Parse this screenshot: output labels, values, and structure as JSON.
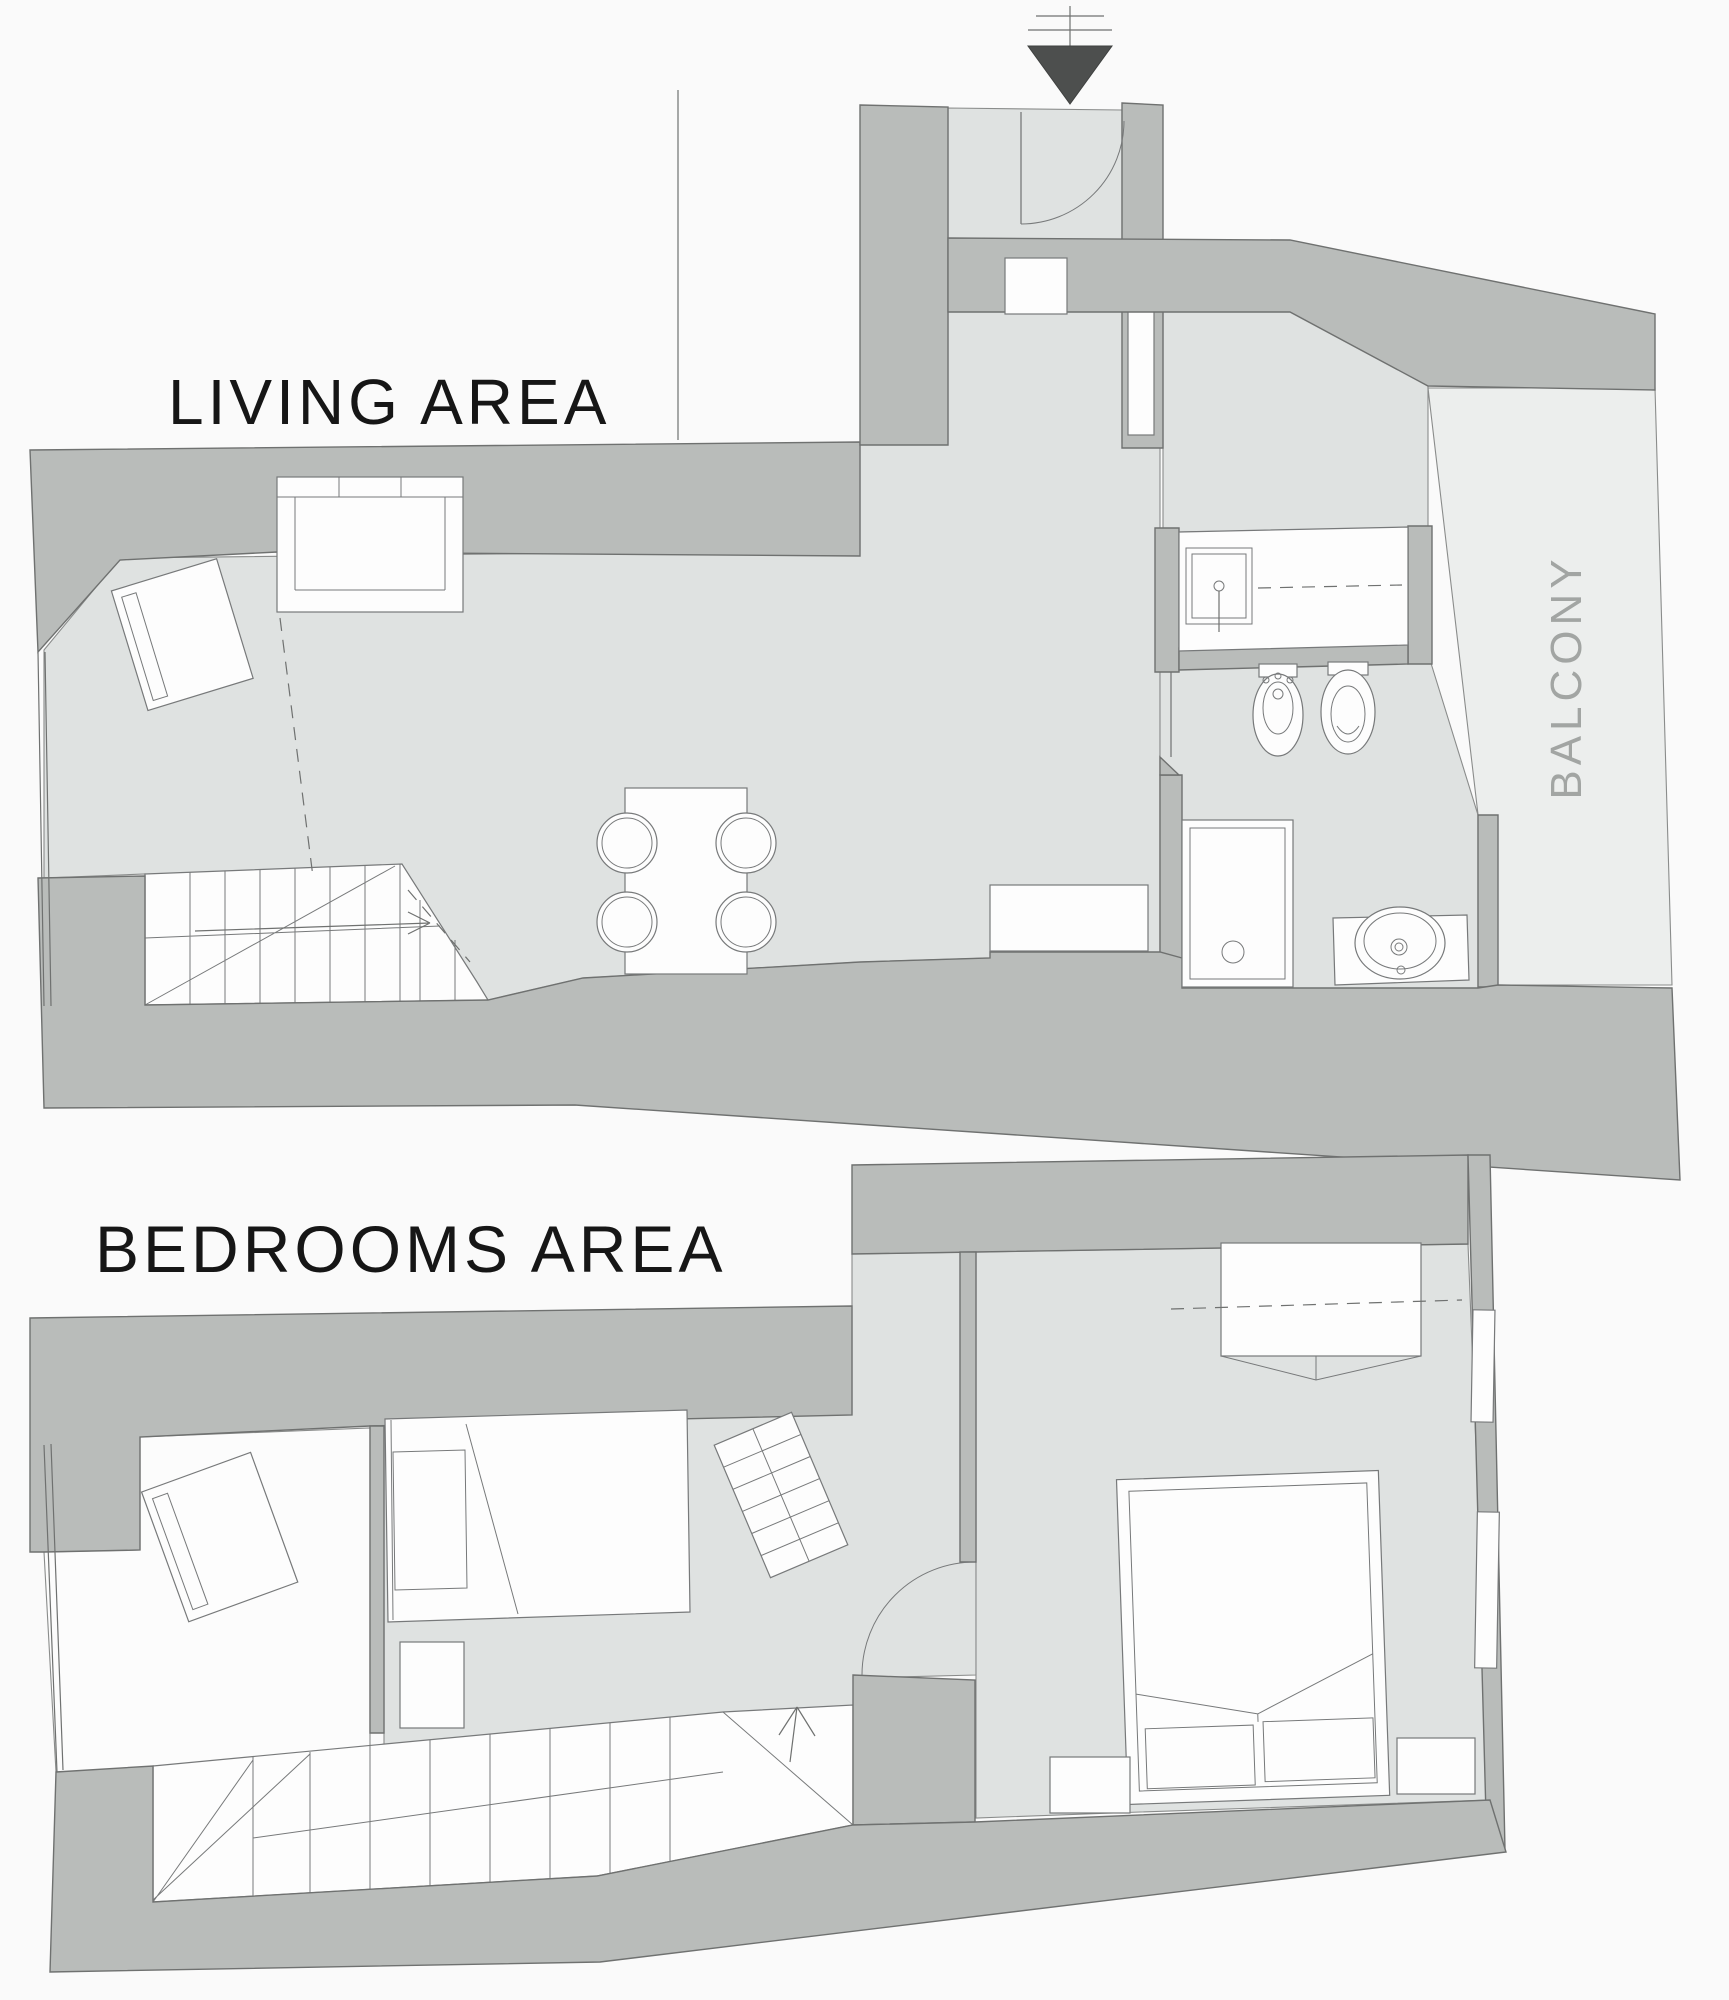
{
  "page": {
    "background": "#fafafa",
    "type": "architectural floor plan, two levels"
  },
  "labels": {
    "living_title": "LIVING AREA",
    "bedrooms_title": "BEDROOMS AREA",
    "balcony": "BALCONY"
  },
  "icons": [
    {
      "name": "entrance-arrow-icon",
      "meaning": "main entrance direction marker",
      "glyph": "filled triangle pointing down with hatch lines above"
    }
  ],
  "colors": {
    "wall": "#b9bcba",
    "floor": "#dfe2e1",
    "balcony_floor": "#eceeed",
    "furniture_white": "#fdfdfd",
    "outline": "#6f7170",
    "title_text": "#161616",
    "balcony_text": "#a2a5a3",
    "entrance_arrow": "#4d4f4e"
  },
  "floors": [
    {
      "name": "living-area",
      "label": "LIVING AREA",
      "rooms": [
        "living room",
        "entrance corridor",
        "kitchen passage",
        "bathroom",
        "balcony"
      ],
      "furniture": [
        "sofa",
        "armchair",
        "dining table with four chairs",
        "staircase down",
        "sideboard",
        "bathtub",
        "bidet",
        "toilet",
        "shower",
        "washbasin"
      ]
    },
    {
      "name": "bedrooms-area",
      "label": "BEDROOMS AREA",
      "rooms": [
        "study room",
        "single bedroom",
        "stair hall",
        "double bedroom"
      ],
      "furniture": [
        "armchair",
        "single bed",
        "desk",
        "cabinet",
        "staircase up",
        "double bed",
        "nightstand left",
        "nightstand right",
        "wardrobe"
      ]
    }
  ]
}
